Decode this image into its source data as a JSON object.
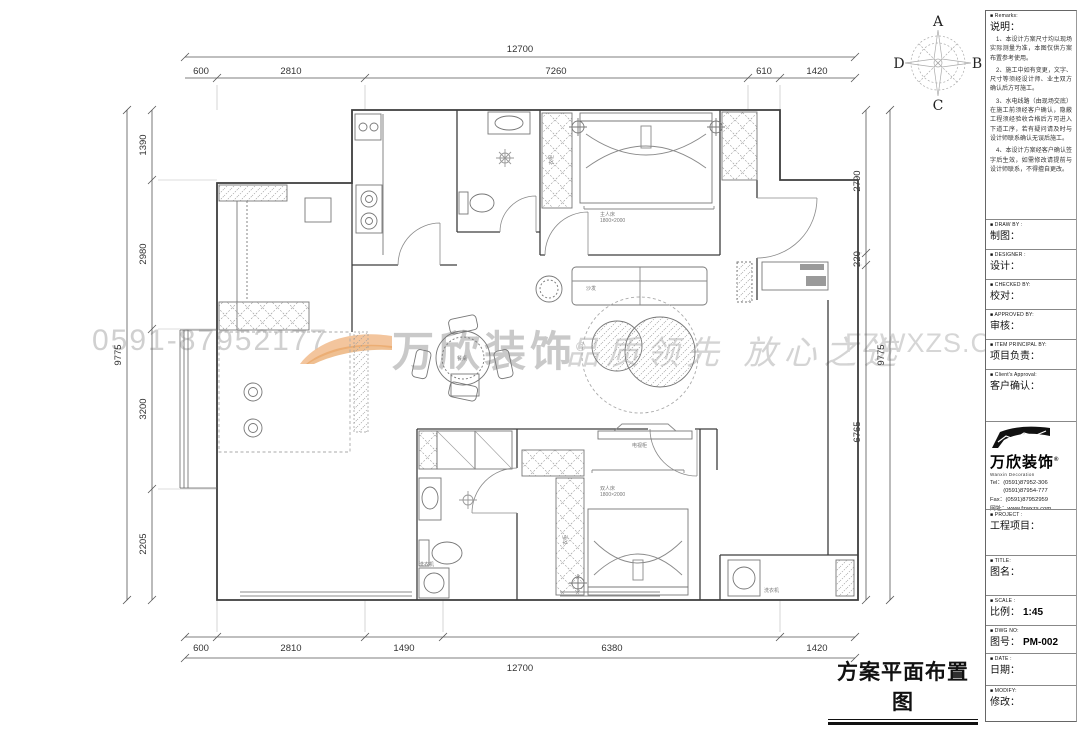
{
  "watermarks": {
    "phone": "0591-87952177",
    "brand": "万欣装饰",
    "brand_reg": "®",
    "slogan": "品质领先 放心之选",
    "url": "FZWXZS.COM"
  },
  "compass": {
    "n": "A",
    "e": "B",
    "s": "C",
    "w": "D"
  },
  "dims": {
    "top": {
      "total": "12700",
      "segments": [
        "600",
        "2810",
        "7260",
        "610",
        "1420"
      ]
    },
    "bottom": {
      "total": "12700",
      "segments": [
        "600",
        "2810",
        "1490",
        "6380",
        "1420"
      ]
    },
    "left": {
      "total": "9775",
      "segments": [
        "1390",
        "2980",
        "3200",
        "2205"
      ]
    },
    "right": {
      "total": "9775",
      "segments": [
        "2790",
        "220",
        "6765"
      ]
    }
  },
  "plan_labels": {
    "master_bed": "主人床",
    "master_bed_size": "1800×2000",
    "double_bed": "双人床",
    "double_bed_size": "1800×2000",
    "dining_table": "餐桌",
    "sofa": "沙发",
    "wardrobe1": "衣柜",
    "wardrobe2": "衣柜",
    "tv_cabinet": "电视柜",
    "washer1": "洗衣机",
    "washer2": "洗衣机"
  },
  "panel": {
    "remarks": {
      "en": "■ Remarks:",
      "zh": "说明：",
      "items": [
        "1、本设计方案尺寸均以现场实际测量为准，本图仅供方案布置参考使用。",
        "2、施工中如有变更，文字、尺寸等须经设计师、业主双方确认后方可施工。",
        "3、水电线路（由现场交底）在施工前须经客户确认，隐蔽工程须经验收合格后方可进入下道工序，若有疑问请及时与设计师联系确认无误后施工。",
        "4、本设计方案经客户确认签字后生效，如需修改请提前与设计师联系，不得擅自更改。"
      ]
    },
    "fields": [
      {
        "en": "■ DRAW  BY :",
        "zh": "制图："
      },
      {
        "en": "■ DESIGNER :",
        "zh": "设计："
      },
      {
        "en": "■ CHECKED  BY:",
        "zh": "校对："
      },
      {
        "en": "■ APPROVED  BY:",
        "zh": "审核："
      },
      {
        "en": "■ ITEM PRINCIPAL BY:",
        "zh": "项目负责："
      },
      {
        "en": "■ Client's Approval:",
        "zh": "客户确认："
      },
      {
        "en": "■ PROJECT :",
        "zh": "工程项目："
      },
      {
        "en": "■ TITLE:",
        "zh": "图名："
      },
      {
        "en": "■ SCALE :",
        "zh": "比例：",
        "value": "1:45"
      },
      {
        "en": "■ DWG NO:",
        "zh": "图号：",
        "value": "PM-002"
      },
      {
        "en": "■ DATE :",
        "zh": "日期："
      },
      {
        "en": "■ MODIFY:",
        "zh": "修改："
      }
    ],
    "logo": {
      "name": "万欣装饰",
      "reg": "®",
      "sub": "Wanxin  Decoration",
      "tel1": "Tel：(0591)87952-306",
      "tel2": "　　 (0591)87954-777",
      "fax": "Fax：(0591)87952959",
      "web": "网址：www.fzwxzs.com"
    }
  },
  "drawing_title": "方案平面布置图"
}
